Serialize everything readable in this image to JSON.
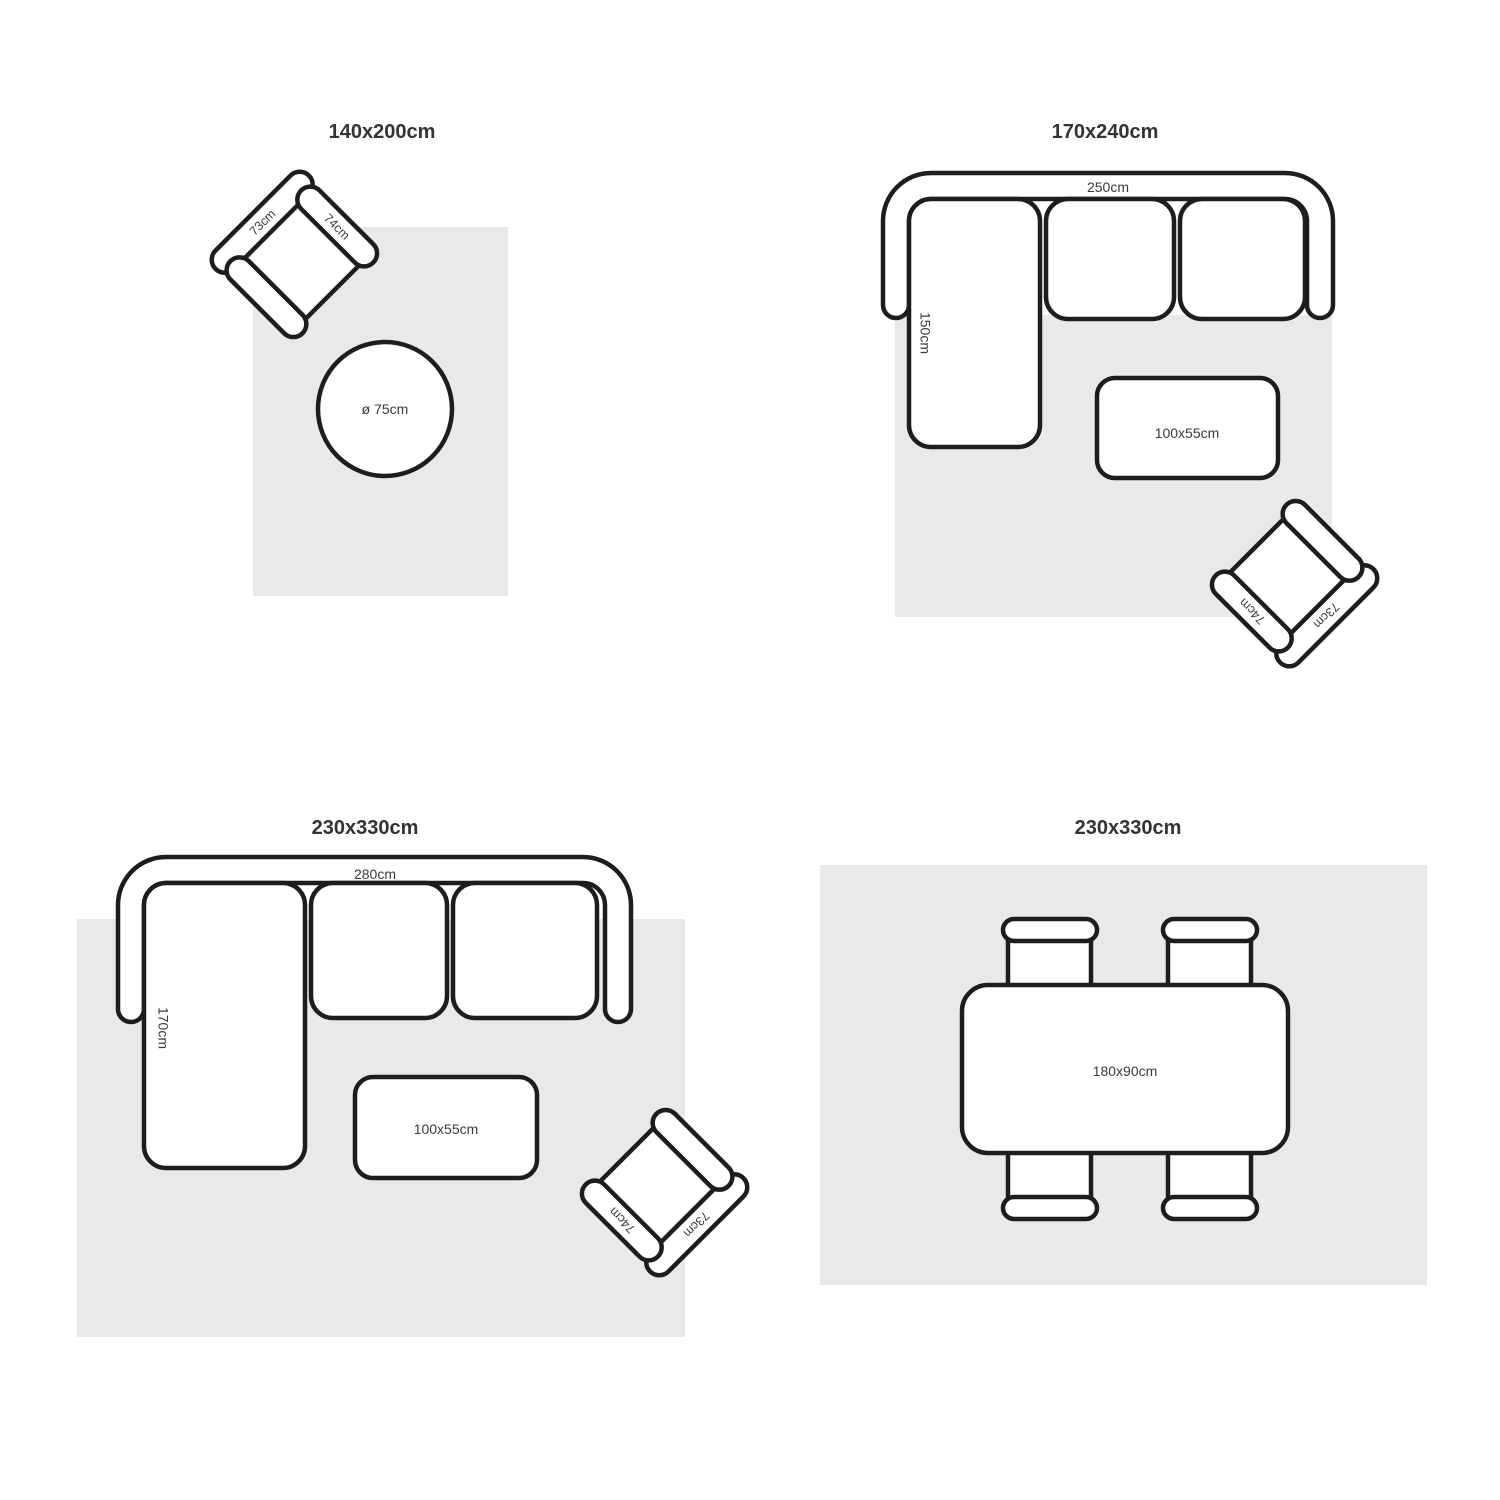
{
  "colors": {
    "background": "#ffffff",
    "rug": "#e9e9e9",
    "line": "#1d1d1b",
    "label": "#3a3a3a",
    "title": "#333333"
  },
  "q1": {
    "title": "140x200cm",
    "armchair": {
      "back": "73cm",
      "arm": "74cm"
    },
    "round_table": "ø 75cm"
  },
  "q2": {
    "title": "170x240cm",
    "sofa": {
      "width": "250cm",
      "chaise": "150cm"
    },
    "coffee_table": "100x55cm",
    "armchair": {
      "back": "73cm",
      "arm": "74cm"
    }
  },
  "q3": {
    "title": "230x330cm",
    "sofa": {
      "width": "280cm",
      "chaise": "170cm"
    },
    "coffee_table": "100x55cm",
    "armchair": {
      "back": "73cm",
      "arm": "74cm"
    }
  },
  "q4": {
    "title": "230x330cm",
    "dining_table": "180x90cm"
  }
}
